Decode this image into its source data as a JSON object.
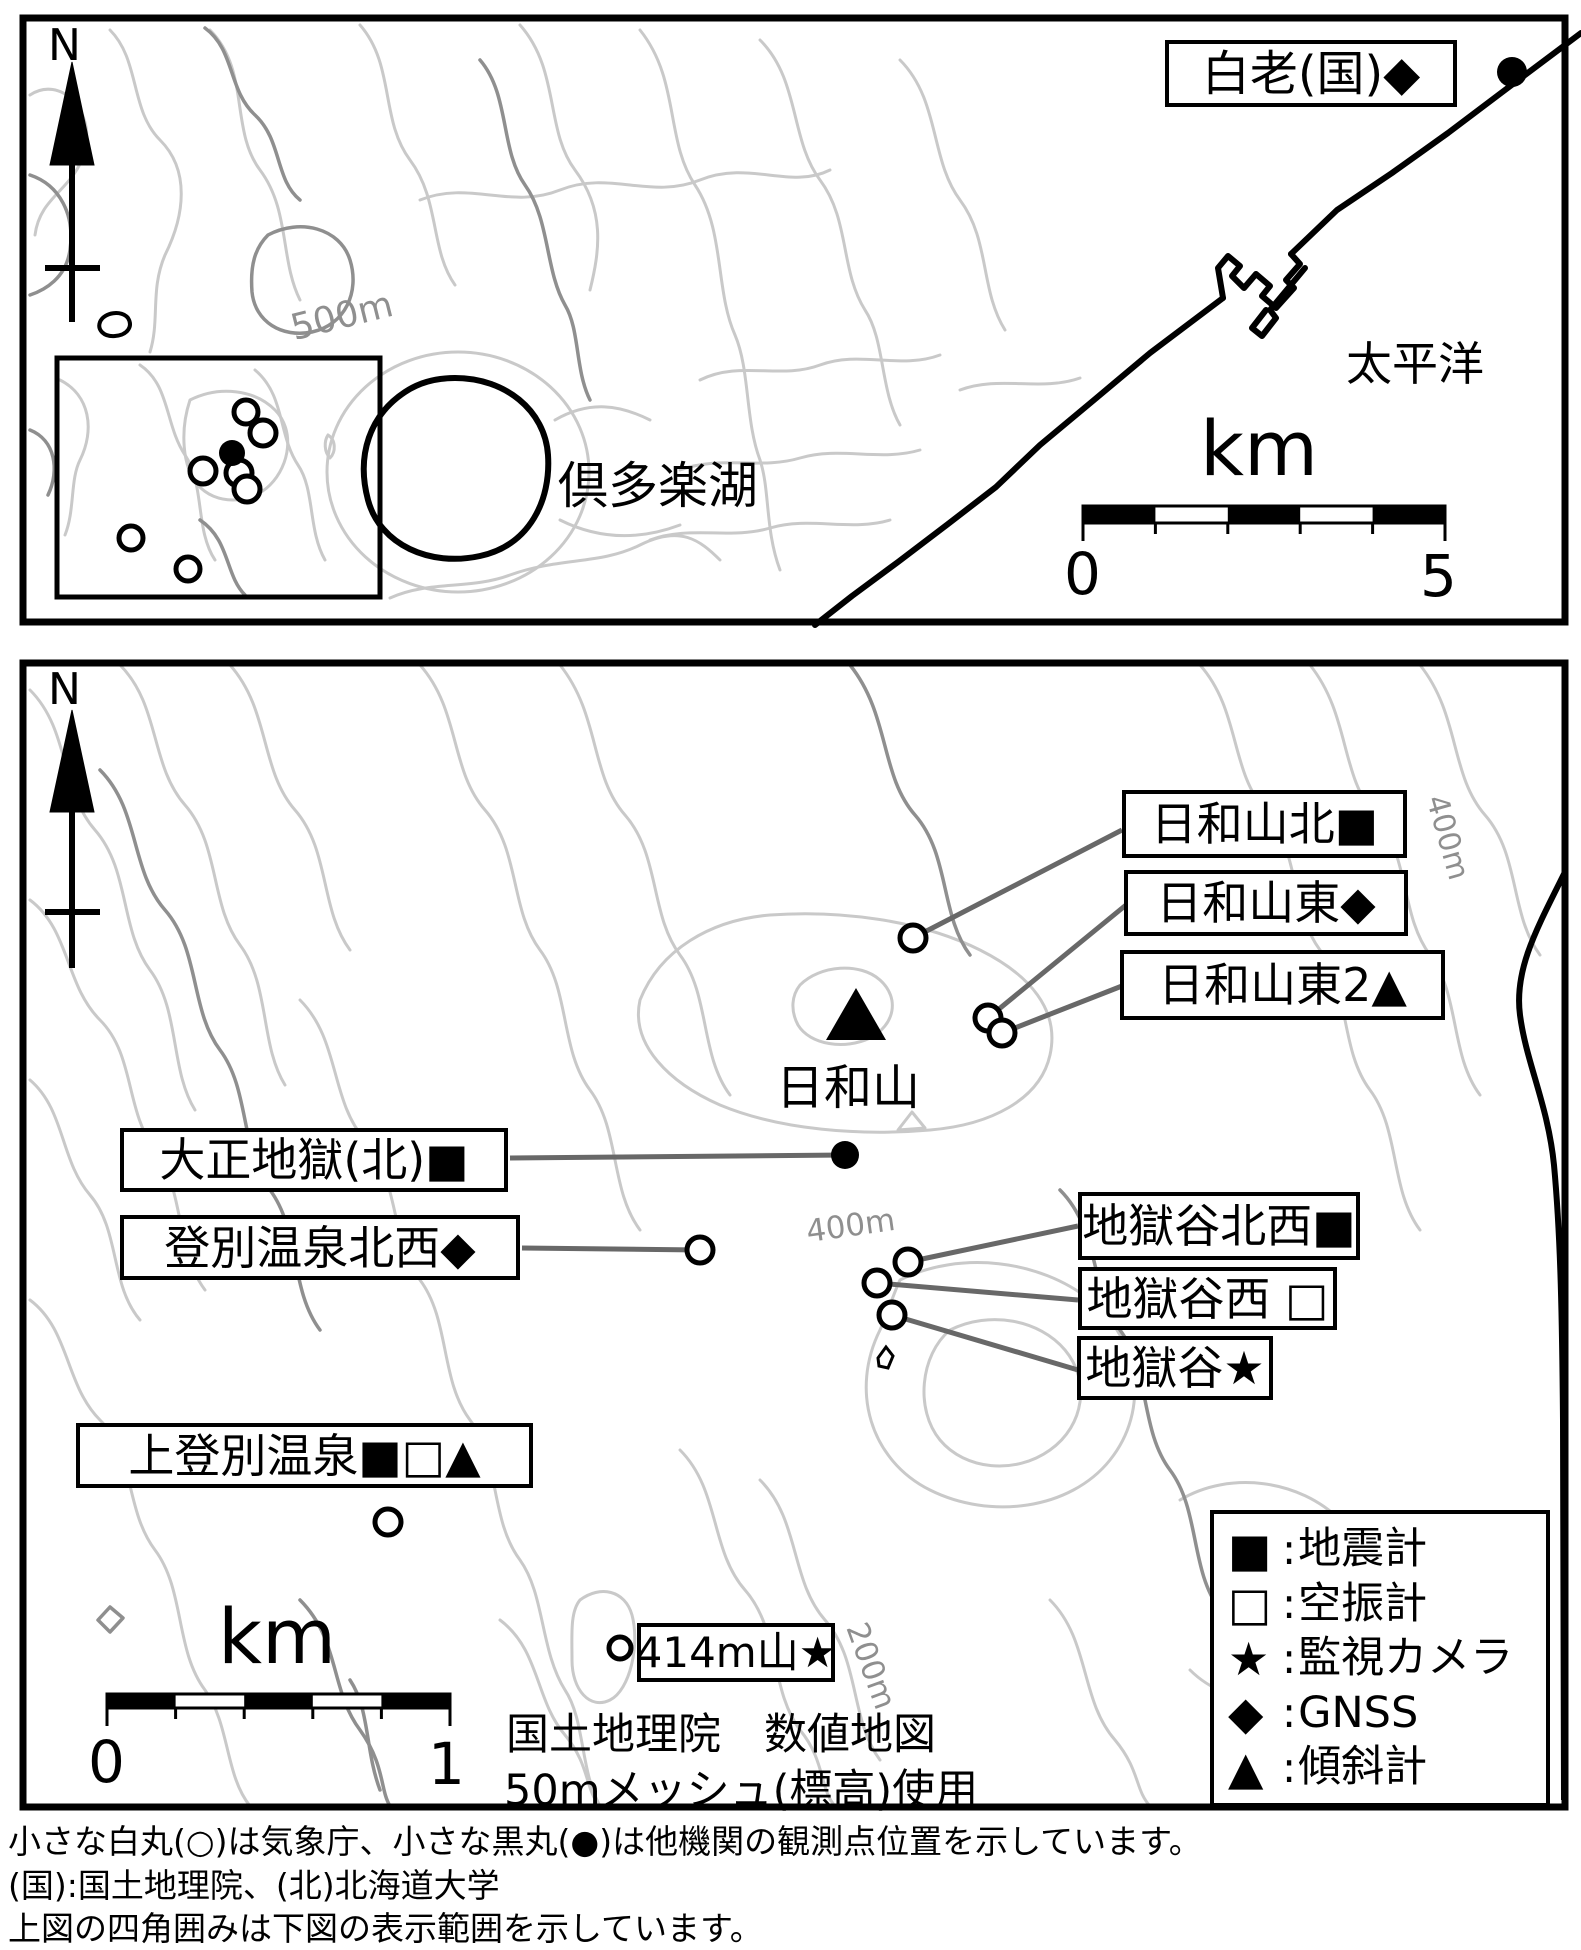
{
  "figure": {
    "background": "#ffffff"
  },
  "overview_map": {
    "north_label": "N",
    "contour_label": "500m",
    "lake_label": "倶多楽湖",
    "sea_label": "太平洋",
    "station_box": "白老(国)◆",
    "scale": {
      "unit": "km",
      "start": "0",
      "end": "5"
    }
  },
  "detail_map": {
    "north_label": "N",
    "summit_label": "日和山",
    "contour_label_400_right": "400m",
    "contour_label_400_mid": "400m",
    "contour_label_200": "200m",
    "stations": [
      {
        "label": "日和山北■"
      },
      {
        "label": "日和山東◆"
      },
      {
        "label": "日和山東2▲"
      },
      {
        "label": "大正地獄(北)■"
      },
      {
        "label": "登別温泉北西◆"
      },
      {
        "label": "地獄谷北西■"
      },
      {
        "label": "地獄谷西 □"
      },
      {
        "label": "地獄谷★"
      },
      {
        "label": "上登別温泉■□▲"
      },
      {
        "label": "414m山★"
      }
    ],
    "legend": {
      "separator": ":",
      "rows": [
        {
          "symbol": "■",
          "name": "地震計"
        },
        {
          "symbol": "□",
          "name": "空振計"
        },
        {
          "symbol": "★",
          "name": "監視カメラ"
        },
        {
          "symbol": "◆",
          "name": "GNSS"
        },
        {
          "symbol": "▲",
          "name": "傾斜計"
        }
      ]
    },
    "scale": {
      "unit": "km",
      "start": "0",
      "end": "1"
    },
    "source_line1": "国土地理院　数値地図",
    "source_line2": "50mメッシュ(標高)使用"
  },
  "footnotes": {
    "line1": "小さな白丸(○)は気象庁、小さな黒丸(●)は他機関の観測点位置を示しています。",
    "line2": "(国):国土地理院、(北)北海道大学",
    "line3": "上図の四角囲みは下図の表示範囲を示しています。"
  }
}
